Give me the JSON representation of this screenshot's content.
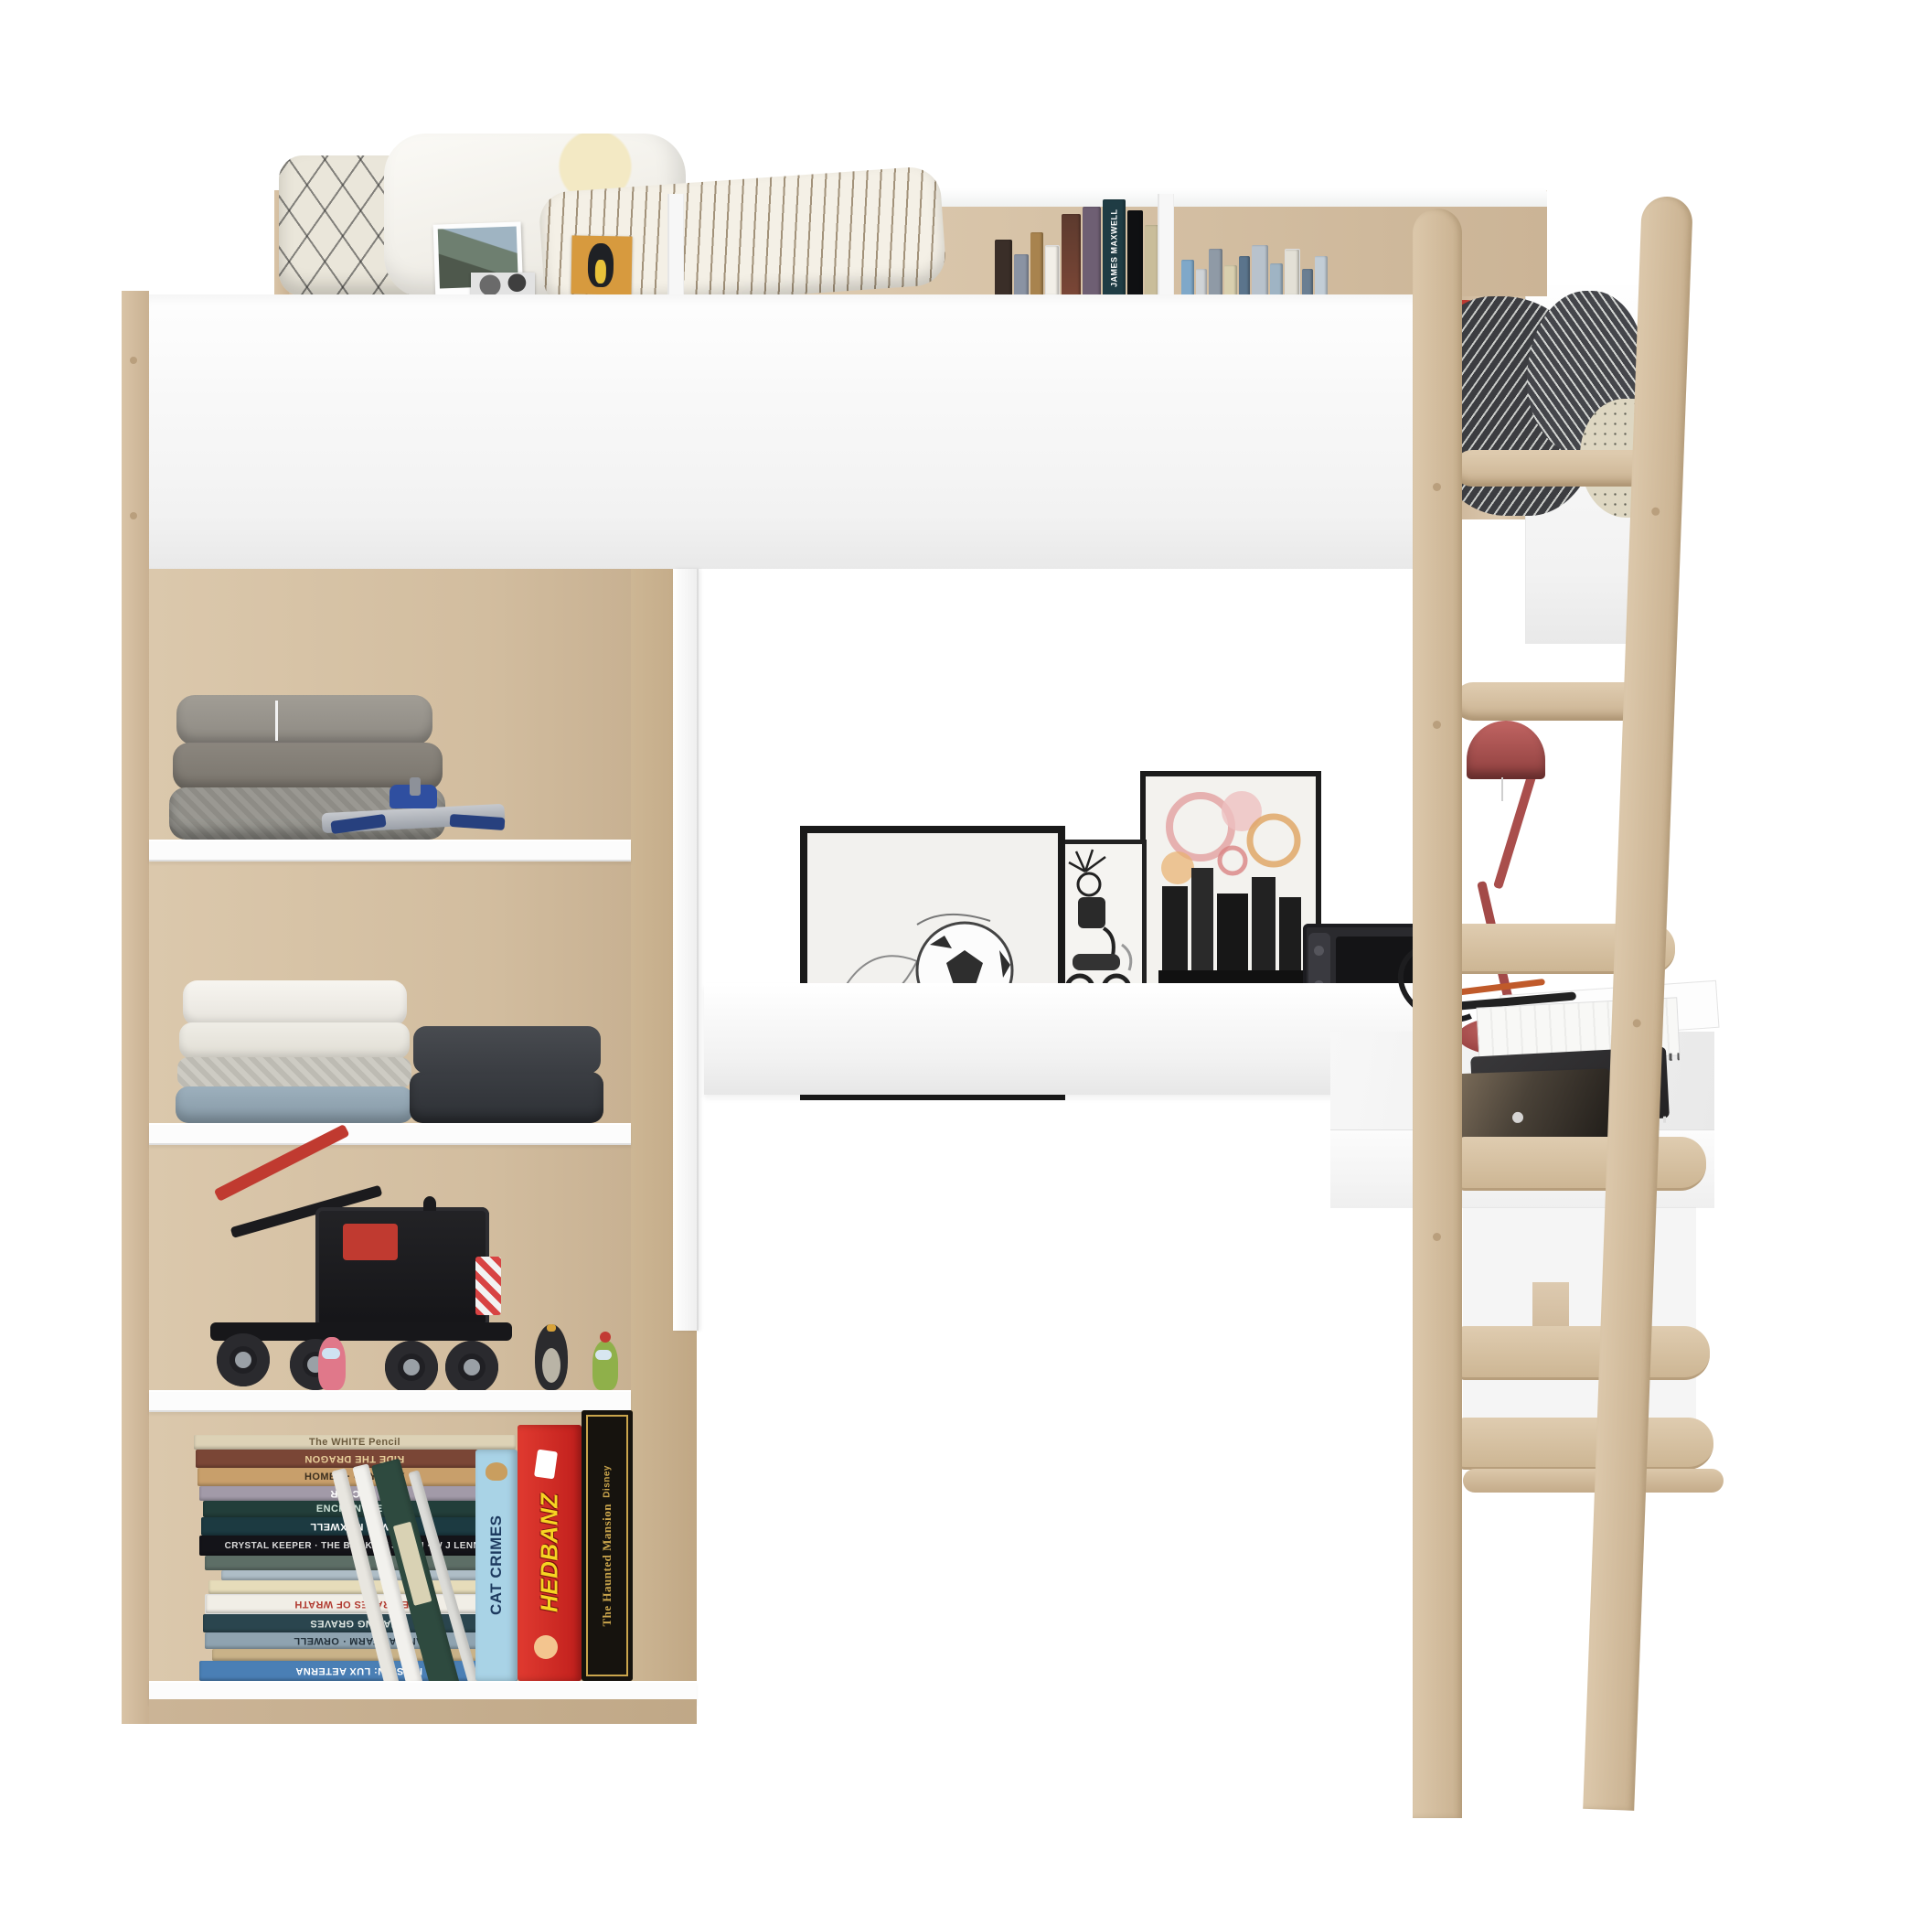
{
  "colors": {
    "wood_oak": "#d5c0a3",
    "panel_white": "#fbfbfb",
    "lamp_red": "#a84b49",
    "cat_crimes_blue": "#a9d3e6",
    "hedbanz_red": "#d42a24",
    "haunted_mansion_black": "#16130e",
    "haunted_mansion_gold": "#caa54c",
    "blanket_dark": "#3c3d41"
  },
  "headboard": {
    "featured_book_title": "JAMES MAXWELL"
  },
  "bottom_shelf": {
    "stack_books": [
      {
        "title": "The WHITE Pencil"
      },
      {
        "title": "RIDE THE DRAGON"
      },
      {
        "title": "HOMER · ODYSSEY"
      },
      {
        "title": "VICTOR"
      },
      {
        "title": "ENCHANTRESS"
      },
      {
        "title": "JAMES MAXWELL"
      },
      {
        "title": "CRYSTAL KEEPER · THE BOOK OF SEVEN · W J LENNOX"
      },
      {
        "title": ""
      },
      {
        "title": ""
      },
      {
        "title": ""
      },
      {
        "title": "THE GRAPES OF WRATH"
      },
      {
        "title": "CHASING GRAVES"
      },
      {
        "title": "ANIMAL FARM · ORWELL"
      },
      {
        "title": ""
      },
      {
        "title": "MISSION: LUX AETERNA"
      }
    ]
  },
  "games": {
    "cat_crimes": "CAT CRIMES",
    "hedbanz": "HEDBANZ",
    "haunted_mansion_brand": "Disney",
    "haunted_mansion": "The Haunted Mansion"
  }
}
